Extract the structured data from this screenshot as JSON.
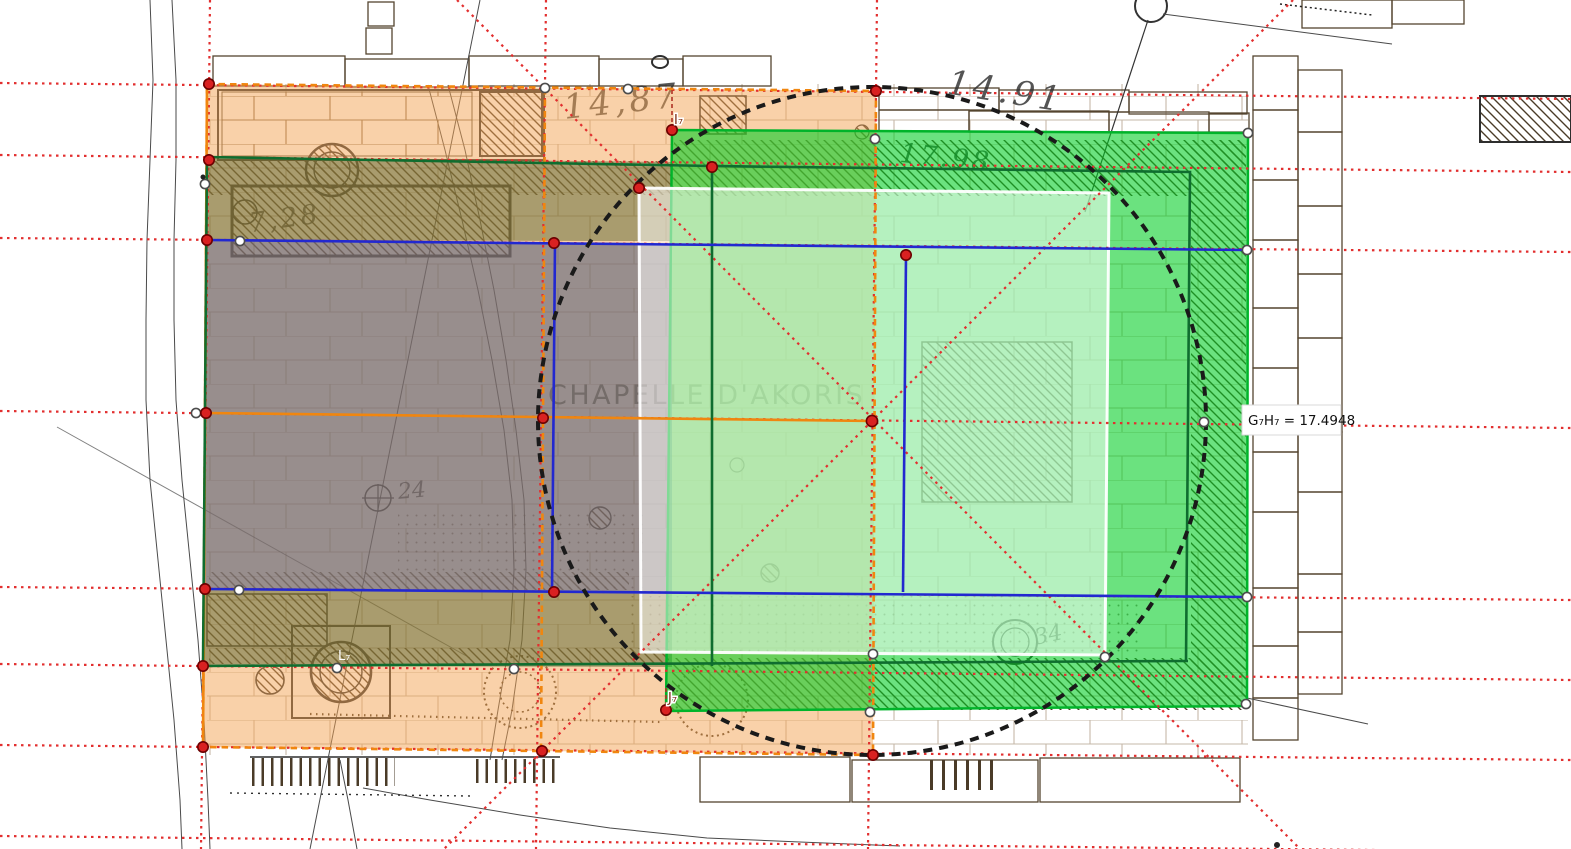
{
  "scene": {
    "chapel_title": "CHAPELLE D'AKORIS",
    "measurement_label": "G₇H₇ = 17.4948",
    "point_labels": {
      "top": "I₇",
      "bottom": "J₇",
      "left": "L₇"
    },
    "handwritten": {
      "top_left": "14,87",
      "top_right": "14.91",
      "left_band": "7,28",
      "green_band": "17.98",
      "circle_left": "24",
      "circle_right": "34"
    },
    "colors": {
      "orange_overlay": "#F4A454",
      "olive_overlay": "#465C26",
      "gray_overlay": "#495876",
      "green_overlay": "#00D22D",
      "white_overlay": "#FFFFFF",
      "blue_line": "#2228D0",
      "orange_line": "#F0860F",
      "red_dotted": "#E22F2F",
      "dark_green_line": "#0F6D2F",
      "circle_stroke": "#1A1A1A",
      "plan_ink": "#55452F"
    }
  }
}
